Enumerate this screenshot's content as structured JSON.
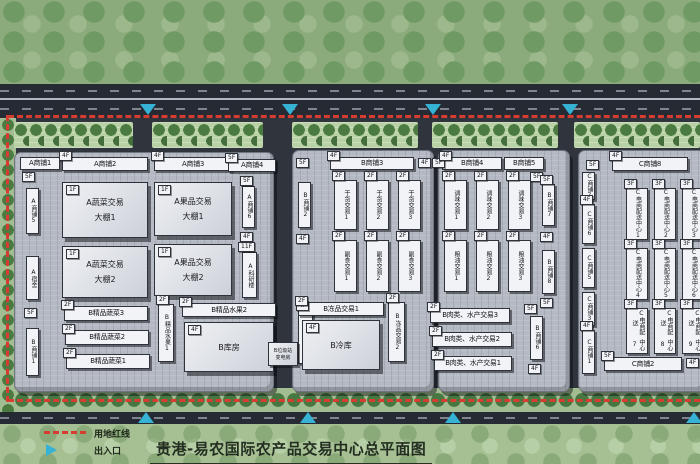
{
  "title": "贵港-易农国际农产品交易中心总平面图",
  "legend": {
    "red_line_label": "用地红线",
    "entrance_label": "出入口",
    "red_line_symbol": "red-dashed-line",
    "entrance_symbol": "blue-triangle"
  },
  "colors": {
    "boundary_red": "#d63c30",
    "entrance_cyan": "#35b2d4",
    "road": "#262a33",
    "site_base": "#30343d",
    "platform": "#b4b9c3",
    "building_face": "#f2f3f6",
    "tree_green": "#4c7b42",
    "strip_green": "#b9d2a5",
    "belt_green": "#8cab7d",
    "legend_green": "#a6c094",
    "title_color": "#232e20"
  },
  "platforms": [
    {
      "x": 14,
      "y": 152,
      "w": 258,
      "h": 238
    },
    {
      "x": 292,
      "y": 150,
      "w": 140,
      "h": 240
    },
    {
      "x": 438,
      "y": 150,
      "w": 130,
      "h": 240
    },
    {
      "x": 578,
      "y": 150,
      "w": 126,
      "h": 240
    }
  ],
  "tree_strips": [
    {
      "x": 14,
      "y": 122,
      "w": 119
    },
    {
      "x": 152,
      "y": 122,
      "w": 111
    },
    {
      "x": 292,
      "y": 122,
      "w": 126
    },
    {
      "x": 432,
      "y": 122,
      "w": 126
    },
    {
      "x": 574,
      "y": 122,
      "w": 126
    }
  ],
  "entrances": {
    "top_x": [
      140,
      282,
      425,
      562
    ],
    "bottom_x": [
      138,
      300,
      445,
      686
    ]
  },
  "buildings": [
    [
      "h",
      20,
      157,
      40,
      13,
      "",
      "A商铺1"
    ],
    [
      "tag",
      22,
      172,
      "5F"
    ],
    [
      "v",
      26,
      188,
      13,
      46,
      "",
      "A商铺5"
    ],
    [
      "v",
      26,
      256,
      13,
      44,
      "",
      "A宿舍"
    ],
    [
      "tag",
      24,
      308,
      "5F"
    ],
    [
      "v",
      26,
      328,
      13,
      48,
      "",
      "B商铺1"
    ],
    [
      "h",
      62,
      157,
      86,
      14,
      "4F",
      "A商铺2"
    ],
    [
      "shed",
      62,
      182,
      86,
      56,
      "1F",
      [
        "A蔬菜交易",
        "大棚1"
      ]
    ],
    [
      "shed",
      62,
      246,
      86,
      52,
      "1F",
      [
        "A蔬菜交易",
        "大棚2"
      ]
    ],
    [
      "h",
      64,
      306,
      84,
      15,
      "2F",
      "B精品蔬菜3"
    ],
    [
      "h",
      65,
      330,
      84,
      15,
      "2F",
      "B精品蔬菜2"
    ],
    [
      "h",
      66,
      354,
      84,
      15,
      "2F",
      "B精品蔬菜1"
    ],
    [
      "h",
      154,
      157,
      78,
      14,
      "4F",
      "A商铺3"
    ],
    [
      "h",
      228,
      159,
      48,
      13,
      "5F",
      "A商铺4"
    ],
    [
      "shed",
      154,
      182,
      78,
      54,
      "1F",
      [
        "A果品交易",
        "大棚1"
      ]
    ],
    [
      "shed",
      154,
      244,
      78,
      52,
      "1F",
      [
        "A果品交易",
        "大棚2"
      ]
    ],
    [
      "tag",
      240,
      176,
      "5F"
    ],
    [
      "v",
      242,
      186,
      13,
      42,
      "",
      "A商铺6"
    ],
    [
      "tag",
      240,
      232,
      "4F"
    ],
    [
      "tag",
      238,
      242,
      "11F"
    ],
    [
      "v",
      242,
      252,
      15,
      46,
      "",
      "A科研楼"
    ],
    [
      "v",
      158,
      304,
      16,
      58,
      "2F",
      "B精品水果1"
    ],
    [
      "h",
      182,
      303,
      94,
      14,
      "2F",
      "B精品水果2"
    ],
    [
      "shed",
      184,
      322,
      90,
      50,
      "4F",
      [
        "B库房"
      ]
    ],
    [
      "tag",
      296,
      158,
      "5F"
    ],
    [
      "v",
      298,
      182,
      13,
      46,
      "",
      "B商铺2"
    ],
    [
      "tag",
      296,
      234,
      "4F"
    ],
    [
      "v",
      298,
      310,
      15,
      54,
      "4F",
      "B科研楼"
    ],
    [
      "h",
      330,
      157,
      84,
      13,
      "4F",
      "B商铺3"
    ],
    [
      "tag",
      418,
      158,
      "4F"
    ],
    [
      "v",
      334,
      180,
      23,
      50,
      "2F",
      "干货交易1"
    ],
    [
      "v",
      366,
      180,
      23,
      50,
      "2F",
      "干货交易2"
    ],
    [
      "v",
      398,
      180,
      23,
      50,
      "2F",
      "干货交易3"
    ],
    [
      "v",
      334,
      240,
      23,
      52,
      "2F",
      "副食交易1"
    ],
    [
      "v",
      366,
      240,
      23,
      52,
      "2F",
      "副食交易2"
    ],
    [
      "v",
      398,
      240,
      23,
      52,
      "2F",
      "副食交易3"
    ],
    [
      "h",
      298,
      302,
      86,
      14,
      "2F",
      "B冻品交易1"
    ],
    [
      "shed",
      302,
      320,
      78,
      50,
      "4F",
      [
        "B冷库"
      ]
    ],
    [
      "v",
      388,
      302,
      17,
      60,
      "2F",
      "B冻品交易2"
    ],
    [
      "shed",
      268,
      342,
      30,
      24,
      "",
      [
        "B垃圾站",
        "变电房"
      ]
    ],
    [
      "tag",
      432,
      158,
      "5F"
    ],
    [
      "h",
      442,
      157,
      60,
      13,
      "4F",
      "B商铺4"
    ],
    [
      "h",
      504,
      157,
      40,
      13,
      "",
      "B商铺5"
    ],
    [
      "tag",
      530,
      172,
      "5F"
    ],
    [
      "v",
      444,
      180,
      23,
      50,
      "2F",
      "调味交易1"
    ],
    [
      "v",
      476,
      180,
      23,
      50,
      "2F",
      "调味交易2"
    ],
    [
      "v",
      508,
      180,
      23,
      50,
      "2F",
      "调味交易3"
    ],
    [
      "v",
      444,
      240,
      23,
      52,
      "2F",
      "粮油交易1"
    ],
    [
      "v",
      476,
      240,
      23,
      52,
      "2F",
      "粮油交易2"
    ],
    [
      "v",
      508,
      240,
      23,
      52,
      "2F",
      "粮油交易3"
    ],
    [
      "v",
      542,
      184,
      13,
      42,
      "5F",
      "B商铺7"
    ],
    [
      "tag",
      540,
      232,
      "4F"
    ],
    [
      "v",
      542,
      250,
      13,
      44,
      "",
      "B商铺8"
    ],
    [
      "tag",
      540,
      298,
      "5F"
    ],
    [
      "h",
      430,
      308,
      80,
      15,
      "2F",
      "B肉类、水产交易3"
    ],
    [
      "h",
      432,
      332,
      80,
      15,
      "2F",
      "B肉类、水产交易2"
    ],
    [
      "h",
      434,
      356,
      78,
      15,
      "2F",
      "B肉类、水产交易1"
    ],
    [
      "tag",
      524,
      304,
      "5F"
    ],
    [
      "v",
      530,
      316,
      13,
      44,
      "",
      "B商铺6"
    ],
    [
      "tag",
      528,
      364,
      "4F"
    ],
    [
      "tag",
      586,
      160,
      "5F"
    ],
    [
      "h",
      612,
      157,
      76,
      14,
      "4F",
      "C商铺8"
    ],
    [
      "v",
      582,
      172,
      13,
      28,
      "",
      "C商铺7"
    ],
    [
      "v",
      582,
      204,
      13,
      40,
      "4F",
      "C商铺6"
    ],
    [
      "v",
      582,
      248,
      13,
      40,
      "",
      "C商铺5"
    ],
    [
      "v",
      582,
      292,
      13,
      34,
      "",
      "C商铺3"
    ],
    [
      "v",
      582,
      330,
      13,
      44,
      "4F",
      "C商铺1"
    ],
    [
      "h",
      604,
      357,
      78,
      14,
      "5F",
      "C商铺2"
    ],
    [
      "tag",
      686,
      358,
      "4F"
    ],
    [
      "v",
      626,
      188,
      22,
      52,
      "3F",
      [
        "C电商配送",
        "中心1"
      ]
    ],
    [
      "v",
      654,
      188,
      22,
      52,
      "3F",
      [
        "C电商配送",
        "中心2"
      ]
    ],
    [
      "v",
      682,
      188,
      22,
      52,
      "3F",
      [
        "C电商配送",
        "中心3"
      ]
    ],
    [
      "v",
      626,
      248,
      22,
      52,
      "3F",
      [
        "C电商配送",
        "中心4"
      ]
    ],
    [
      "v",
      654,
      248,
      22,
      52,
      "3F",
      [
        "C电商配送",
        "中心5"
      ]
    ],
    [
      "v",
      682,
      248,
      22,
      52,
      "3F",
      [
        "C电商配送",
        "中心6"
      ]
    ],
    [
      "v",
      626,
      308,
      22,
      46,
      "3F",
      [
        "C电商配送",
        "中心7"
      ]
    ],
    [
      "v",
      654,
      308,
      22,
      46,
      "3F",
      [
        "C电商配送",
        "中心8"
      ]
    ],
    [
      "v",
      682,
      308,
      22,
      46,
      "3F",
      [
        "C电商配送",
        "中心9"
      ]
    ]
  ]
}
